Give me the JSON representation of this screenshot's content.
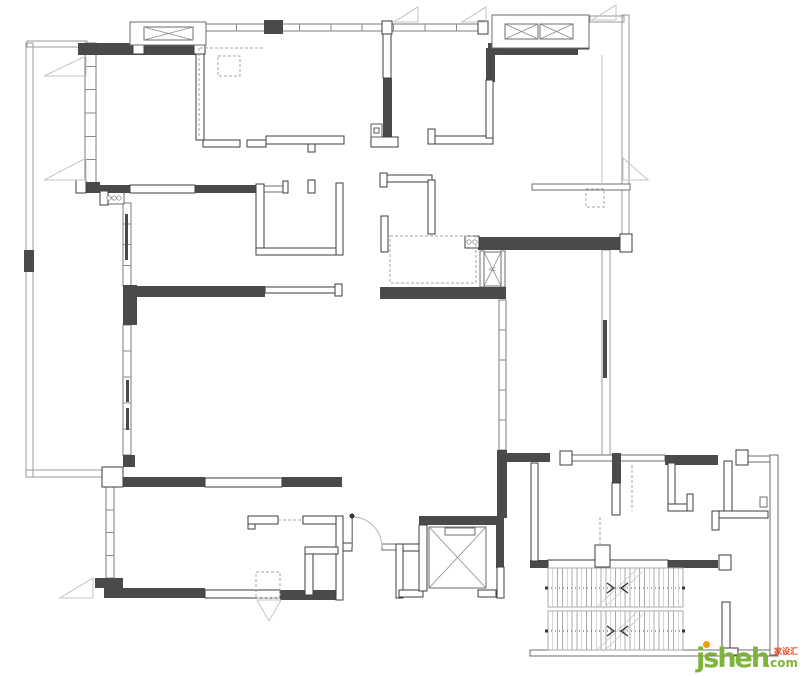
{
  "watermark": {
    "brand": "jsheh",
    "tld": ".com",
    "badge": "家设汇",
    "brand_color": "#7fb43c",
    "dot_color": "#f59b00",
    "badge_color": "#e8401c"
  },
  "palette": {
    "wall_dark": "#4a4a4a",
    "wall_outline": "#3e3e3e",
    "window_line": "#7d7d7d",
    "background": "#ffffff"
  },
  "plan": {
    "width": 800,
    "height": 677,
    "rails": [
      [
        26,
        43,
        7,
        434
      ],
      [
        26,
        470,
        80,
        7
      ],
      [
        27,
        41,
        60,
        6
      ],
      [
        622,
        15,
        7,
        223
      ],
      [
        590,
        16,
        34,
        6
      ],
      [
        602,
        250,
        8,
        206
      ]
    ],
    "windows": [
      [
        85,
        43,
        11,
        140,
        5
      ],
      [
        123,
        203,
        8,
        83,
        3
      ],
      [
        123,
        325,
        8,
        130,
        4
      ],
      [
        106,
        487,
        8,
        91,
        3
      ],
      [
        499,
        300,
        7,
        150,
        4
      ],
      [
        205,
        24,
        283,
        7,
        8
      ]
    ],
    "thin": [
      [
        263,
        186,
        20,
        6
      ],
      [
        532,
        184,
        98,
        6
      ],
      [
        570,
        455,
        95,
        6
      ],
      [
        748,
        456,
        24,
        6
      ],
      [
        530,
        650,
        248,
        6
      ],
      [
        770,
        455,
        8,
        200
      ],
      [
        104,
        192,
        20,
        12
      ],
      [
        760,
        497,
        7,
        10
      ],
      [
        382,
        544,
        16,
        6
      ],
      [
        480,
        251,
        4,
        36
      ],
      [
        501,
        251,
        4,
        36
      ]
    ],
    "darks": [
      [
        78,
        43,
        125,
        12
      ],
      [
        264,
        20,
        19,
        14
      ],
      [
        488,
        43,
        90,
        12
      ],
      [
        486,
        48,
        9,
        34
      ],
      [
        383,
        78,
        9,
        68
      ],
      [
        80,
        185,
        50,
        8
      ],
      [
        195,
        185,
        68,
        8
      ],
      [
        85,
        182,
        15,
        10
      ],
      [
        478,
        237,
        144,
        13
      ],
      [
        123,
        285,
        14,
        40
      ],
      [
        123,
        286,
        142,
        11
      ],
      [
        380,
        287,
        126,
        12
      ],
      [
        497,
        450,
        10,
        68
      ],
      [
        505,
        453,
        45,
        9
      ],
      [
        665,
        455,
        53,
        10
      ],
      [
        612,
        453,
        9,
        30
      ],
      [
        123,
        455,
        12,
        12
      ],
      [
        123,
        477,
        82,
        10
      ],
      [
        282,
        477,
        60,
        10
      ],
      [
        95,
        578,
        28,
        10
      ],
      [
        104,
        588,
        101,
        10
      ],
      [
        280,
        590,
        62,
        10
      ],
      [
        419,
        516,
        81,
        9
      ],
      [
        496,
        516,
        8,
        52
      ],
      [
        530,
        560,
        18,
        8
      ],
      [
        667,
        560,
        51,
        8
      ],
      [
        24,
        250,
        10,
        22
      ],
      [
        125,
        214,
        3,
        46
      ],
      [
        126,
        380,
        3,
        22
      ],
      [
        126,
        408,
        3,
        22
      ],
      [
        603,
        320,
        4,
        58
      ]
    ],
    "walls": [
      [
        196,
        44,
        8,
        96
      ],
      [
        203,
        140,
        37,
        7
      ],
      [
        247,
        140,
        19,
        7
      ],
      [
        266,
        136,
        78,
        8
      ],
      [
        308,
        144,
        7,
        8
      ],
      [
        371,
        137,
        27,
        10
      ],
      [
        429,
        136,
        64,
        8
      ],
      [
        428,
        129,
        7,
        15
      ],
      [
        486,
        80,
        7,
        58
      ],
      [
        383,
        30,
        8,
        48
      ],
      [
        382,
        21,
        10,
        13
      ],
      [
        478,
        21,
        10,
        13
      ],
      [
        130,
        185,
        65,
        8
      ],
      [
        283,
        181,
        5,
        12
      ],
      [
        100,
        191,
        8,
        14
      ],
      [
        256,
        184,
        8,
        71
      ],
      [
        256,
        248,
        87,
        7
      ],
      [
        336,
        183,
        7,
        72
      ],
      [
        308,
        180,
        7,
        13
      ],
      [
        386,
        175,
        46,
        7
      ],
      [
        380,
        173,
        7,
        14
      ],
      [
        428,
        180,
        7,
        54
      ],
      [
        381,
        216,
        7,
        36
      ],
      [
        465,
        236,
        14,
        12
      ],
      [
        620,
        234,
        12,
        18
      ],
      [
        265,
        287,
        73,
        6
      ],
      [
        335,
        284,
        7,
        12
      ],
      [
        560,
        451,
        12,
        14
      ],
      [
        736,
        450,
        12,
        15
      ],
      [
        668,
        463,
        7,
        48
      ],
      [
        668,
        504,
        25,
        7
      ],
      [
        687,
        494,
        6,
        17
      ],
      [
        724,
        461,
        8,
        57
      ],
      [
        712,
        511,
        56,
        7
      ],
      [
        712,
        511,
        7,
        19
      ],
      [
        612,
        483,
        8,
        32
      ],
      [
        531,
        463,
        7,
        98
      ],
      [
        548,
        560,
        120,
        8
      ],
      [
        595,
        545,
        15,
        22
      ],
      [
        719,
        555,
        12,
        15
      ],
      [
        722,
        602,
        8,
        53
      ],
      [
        722,
        648,
        16,
        7
      ],
      [
        102,
        467,
        21,
        20
      ],
      [
        205,
        478,
        77,
        9
      ],
      [
        205,
        590,
        75,
        8
      ],
      [
        248,
        516,
        7,
        13
      ],
      [
        248,
        516,
        30,
        8
      ],
      [
        303,
        516,
        40,
        8
      ],
      [
        336,
        516,
        7,
        84
      ],
      [
        305,
        547,
        33,
        7
      ],
      [
        305,
        554,
        8,
        41
      ],
      [
        343,
        543,
        9,
        8
      ],
      [
        396,
        544,
        28,
        7
      ],
      [
        396,
        544,
        7,
        54
      ],
      [
        399,
        590,
        24,
        7
      ],
      [
        478,
        590,
        18,
        7
      ],
      [
        497,
        567,
        7,
        31
      ],
      [
        419,
        525,
        8,
        66
      ],
      [
        76,
        180,
        10,
        13
      ],
      [
        133,
        22,
        11,
        32
      ],
      [
        194,
        22,
        11,
        32
      ],
      [
        492,
        16,
        11,
        33
      ],
      [
        578,
        16,
        11,
        33
      ]
    ],
    "dash_rects": [
      [
        218,
        56,
        22,
        20
      ],
      [
        586,
        189,
        18,
        18
      ],
      [
        390,
        236,
        86,
        47
      ],
      [
        256,
        572,
        24,
        26
      ]
    ],
    "dash_lines": [
      [
        199,
        48,
        199,
        137
      ],
      [
        200,
        48,
        264,
        48
      ],
      [
        278,
        520,
        303,
        520
      ],
      [
        632,
        465,
        632,
        511
      ],
      [
        600,
        517,
        600,
        545
      ]
    ],
    "light_lines": [
      [
        602,
        55,
        602,
        185
      ]
    ],
    "triangles": [
      [
        [
          86,
          56
        ],
        [
          44,
          76
        ],
        [
          86,
          76
        ]
      ],
      [
        [
          86,
          158
        ],
        [
          44,
          180
        ],
        [
          86,
          180
        ]
      ],
      [
        [
          394,
          22
        ],
        [
          418,
          7
        ],
        [
          418,
          22
        ]
      ],
      [
        [
          462,
          22
        ],
        [
          486,
          7
        ],
        [
          486,
          22
        ]
      ],
      [
        [
          592,
          20
        ],
        [
          616,
          5
        ],
        [
          616,
          20
        ]
      ],
      [
        [
          623,
          158
        ],
        [
          648,
          180
        ],
        [
          623,
          180
        ]
      ],
      [
        [
          93,
          578
        ],
        [
          60,
          598
        ],
        [
          93,
          598
        ]
      ],
      [
        [
          257,
          600
        ],
        [
          281,
          600
        ],
        [
          269,
          621
        ]
      ]
    ],
    "circles": [
      [
        186,
        36,
        2.2
      ],
      [
        193,
        36,
        2.2
      ],
      [
        500,
        39,
        2.2
      ],
      [
        507,
        39,
        2.2
      ],
      [
        109,
        198,
        2.2
      ],
      [
        114,
        198,
        2.2
      ],
      [
        119,
        198,
        2.2
      ],
      [
        469,
        242,
        2.2
      ],
      [
        475,
        242,
        2.2
      ]
    ],
    "squares": [
      {
        "outer": [
          371,
          124,
          11,
          13
        ],
        "inner": [
          374,
          128,
          5,
          5
        ]
      }
    ],
    "xbays": [
      {
        "outer": [
          130,
          22,
          76,
          23
        ],
        "cells": [
          [
            144,
            27,
            49,
            13
          ]
        ]
      },
      {
        "outer": [
          492,
          15,
          97,
          33
        ],
        "cells": [
          [
            505,
            24,
            33,
            15
          ],
          [
            540,
            24,
            33,
            15
          ]
        ]
      }
    ],
    "elevator": {
      "box": [
        429,
        527,
        57,
        61
      ],
      "slot": [
        445,
        528,
        30,
        7
      ]
    },
    "ac": {
      "box": [
        484,
        252,
        17,
        34
      ],
      "label": "A/C",
      "label_x": 492.5,
      "label_y": 271
    },
    "door": {
      "leaf": [
        352,
        517,
        352,
        547
      ],
      "arc": "M 352 517 A 30 30 0 0 1 382 547",
      "hinge": [
        352,
        516,
        2.5
      ]
    },
    "stairs": {
      "flights": [
        {
          "x": 548,
          "y": 568,
          "w": 135,
          "h": 39,
          "rail_y": 588,
          "diag": [
            [
              597,
              607,
              637,
              569
            ],
            [
              603,
              609,
              643,
              571
            ]
          ]
        },
        {
          "x": 548,
          "y": 611,
          "w": 135,
          "h": 39,
          "rail_y": 631,
          "diag": [
            [
              597,
              650,
              637,
              612
            ],
            [
              603,
              652,
              643,
              614
            ]
          ]
        }
      ],
      "tread_count": 27,
      "rail_x": [
        547,
        683
      ],
      "chevrons_x": [
        607,
        628
      ]
    }
  }
}
